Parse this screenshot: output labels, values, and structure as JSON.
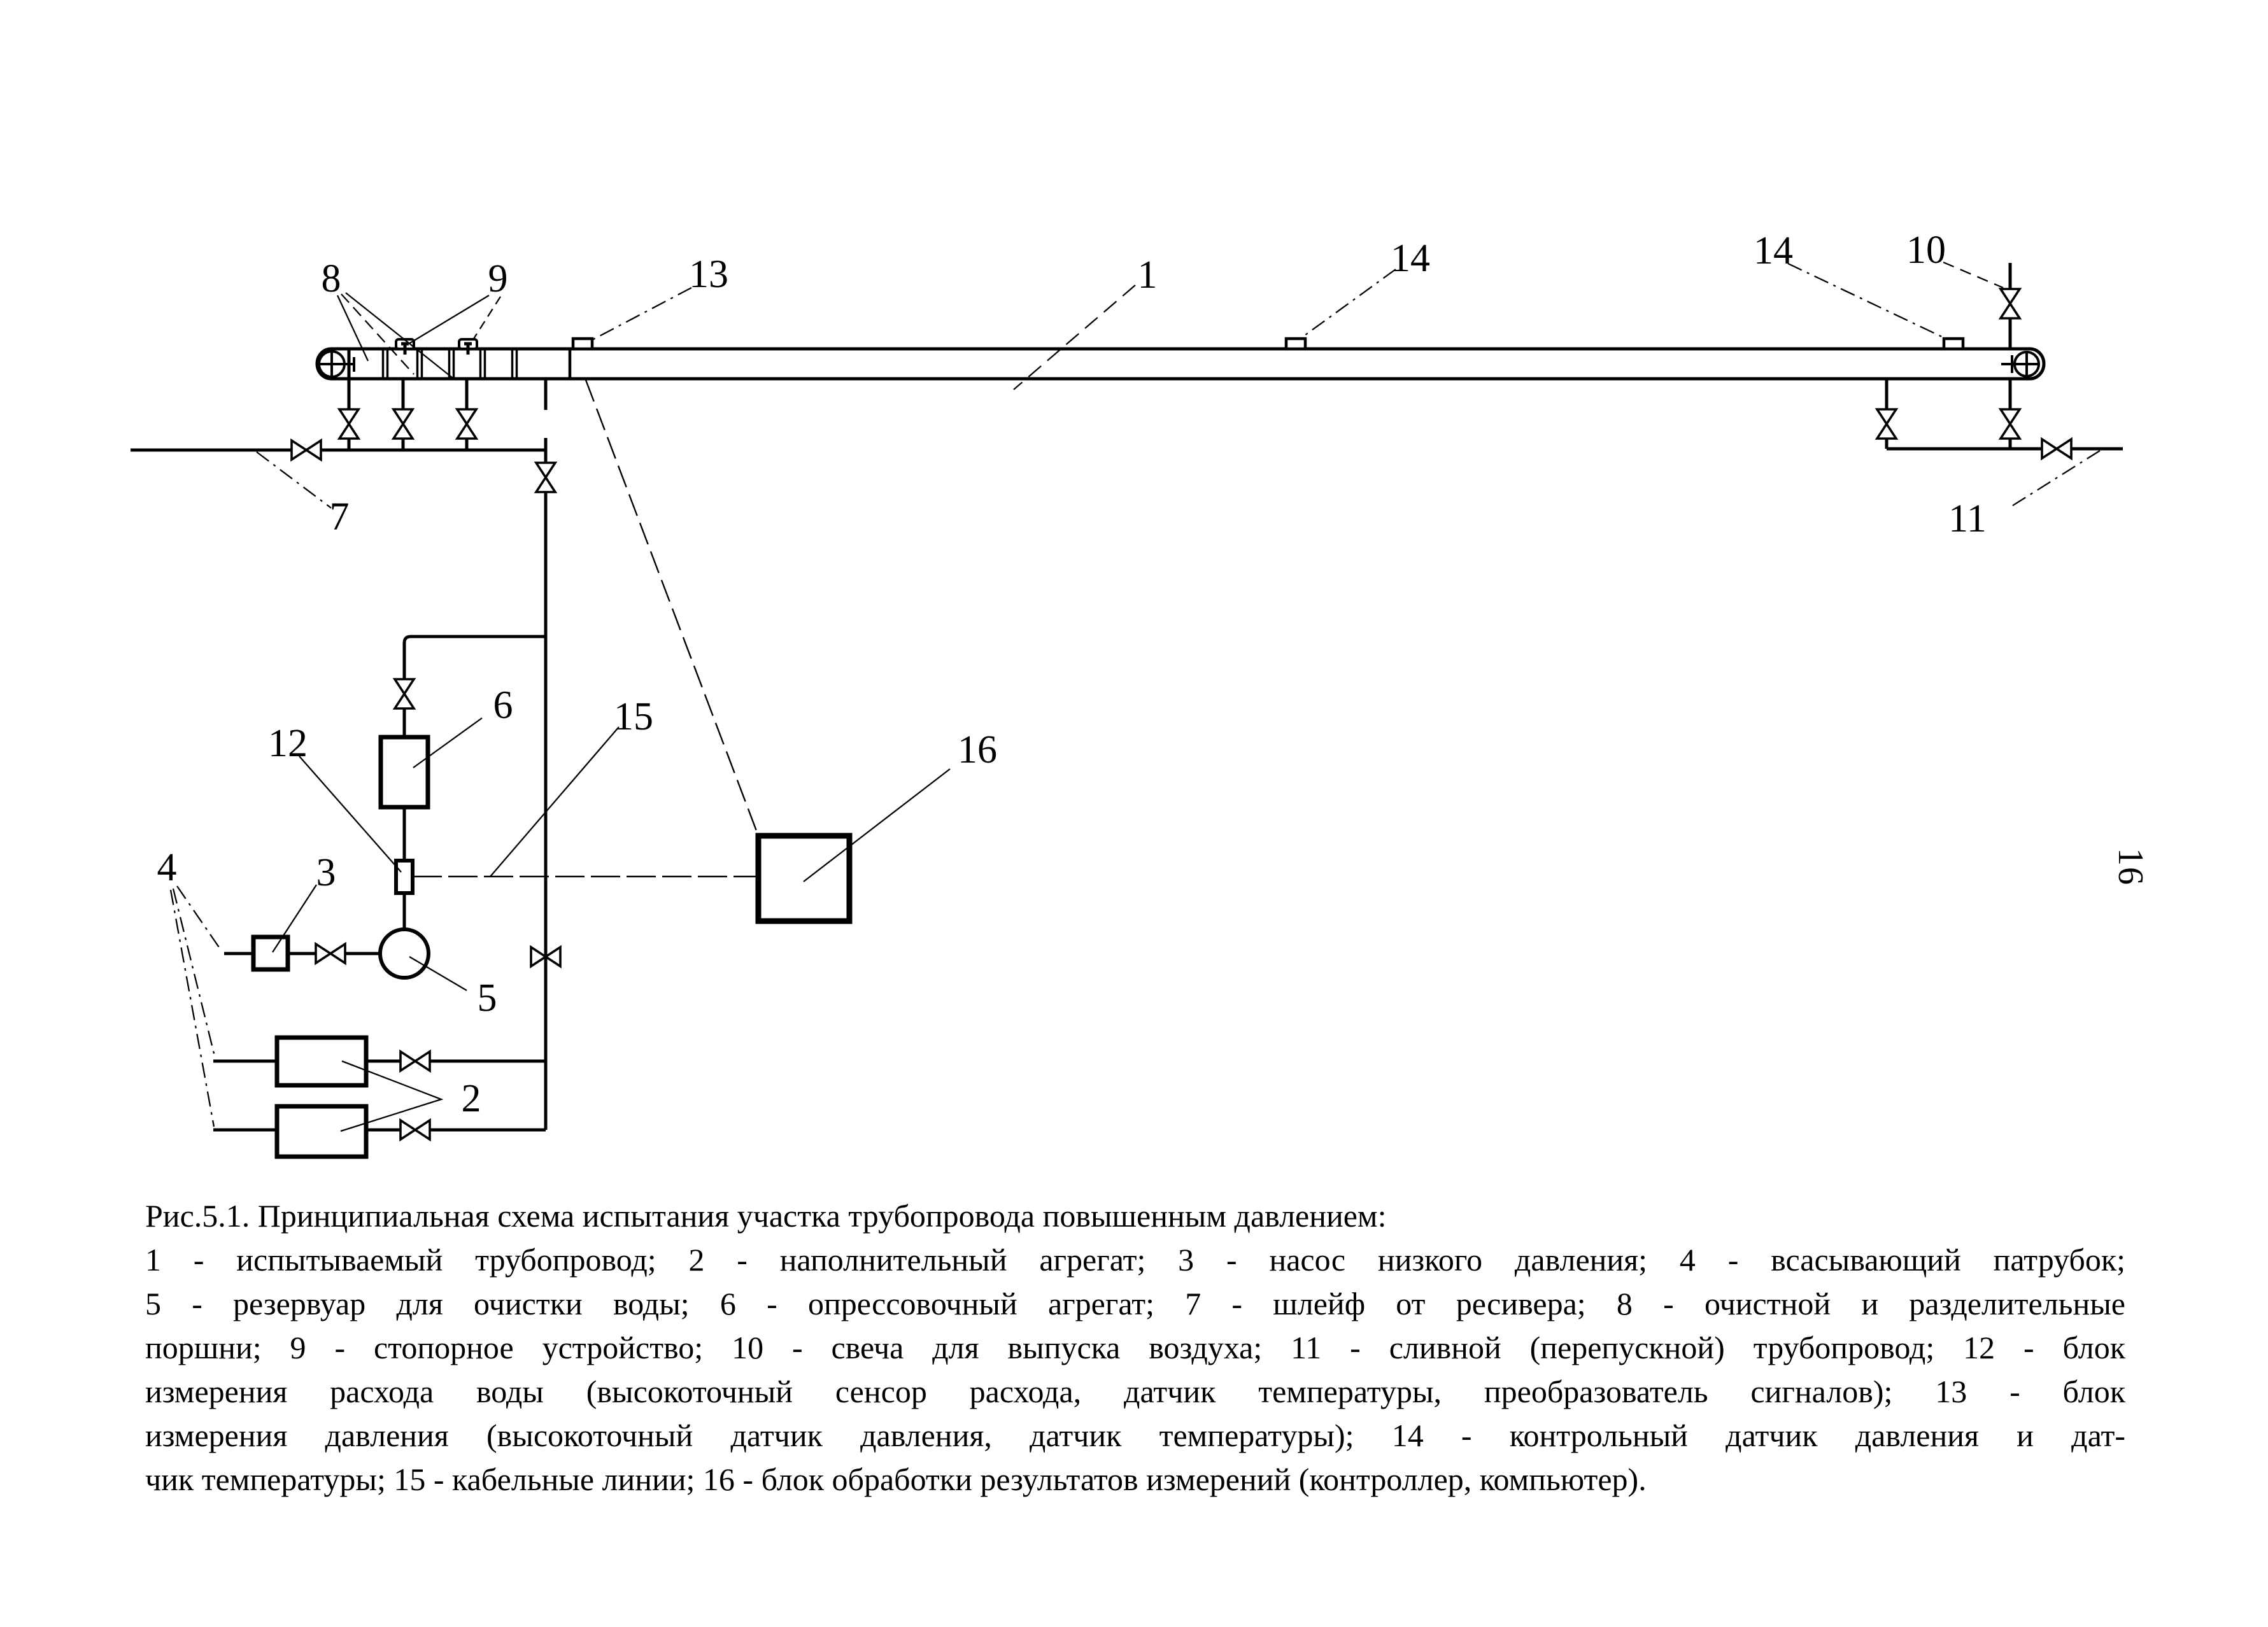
{
  "figure": {
    "labels": {
      "l1": "1",
      "l2": "2",
      "l3": "3",
      "l4": "4",
      "l5": "5",
      "l6": "6",
      "l7": "7",
      "l8": "8",
      "l9": "9",
      "l10": "10",
      "l11": "11",
      "l12": "12",
      "l13": "13",
      "l14_mid": "14",
      "l14_right": "14",
      "l15": "15",
      "l16": "16"
    },
    "page_number": "16",
    "caption": {
      "lines": [
        "Рис.5.1. Принципиальная схема испытания участка трубопровода повышенным давлением:",
        "1 - испытываемый трубопровод; 2 - наполнительный агрегат; 3 - насос низкого давления; 4 - всасывающий патрубок;",
        "5 - резервуар для очистки воды; 6 - опрессовочный агрегат; 7 - шлейф от ресивера; 8 - очистной и разделительные",
        "поршни; 9 - стопорное устройство; 10 - свеча для выпуска воздуха; 11 - сливной (перепускной) трубопровод; 12 - блок",
        "измерения расхода воды (высокоточный сенсор расхода, датчик температуры, преобразователь сигналов); 13 - блок",
        "измерения давления (высокоточный датчик давления, датчик температуры); 14 - контрольный датчик давления и дат-",
        "чик температуры; 15 - кабельные линии; 16 - блок обработки результатов измерений (контроллер, компьютер)."
      ]
    },
    "colors": {
      "ink": "#000000",
      "paper": "#ffffff"
    }
  }
}
